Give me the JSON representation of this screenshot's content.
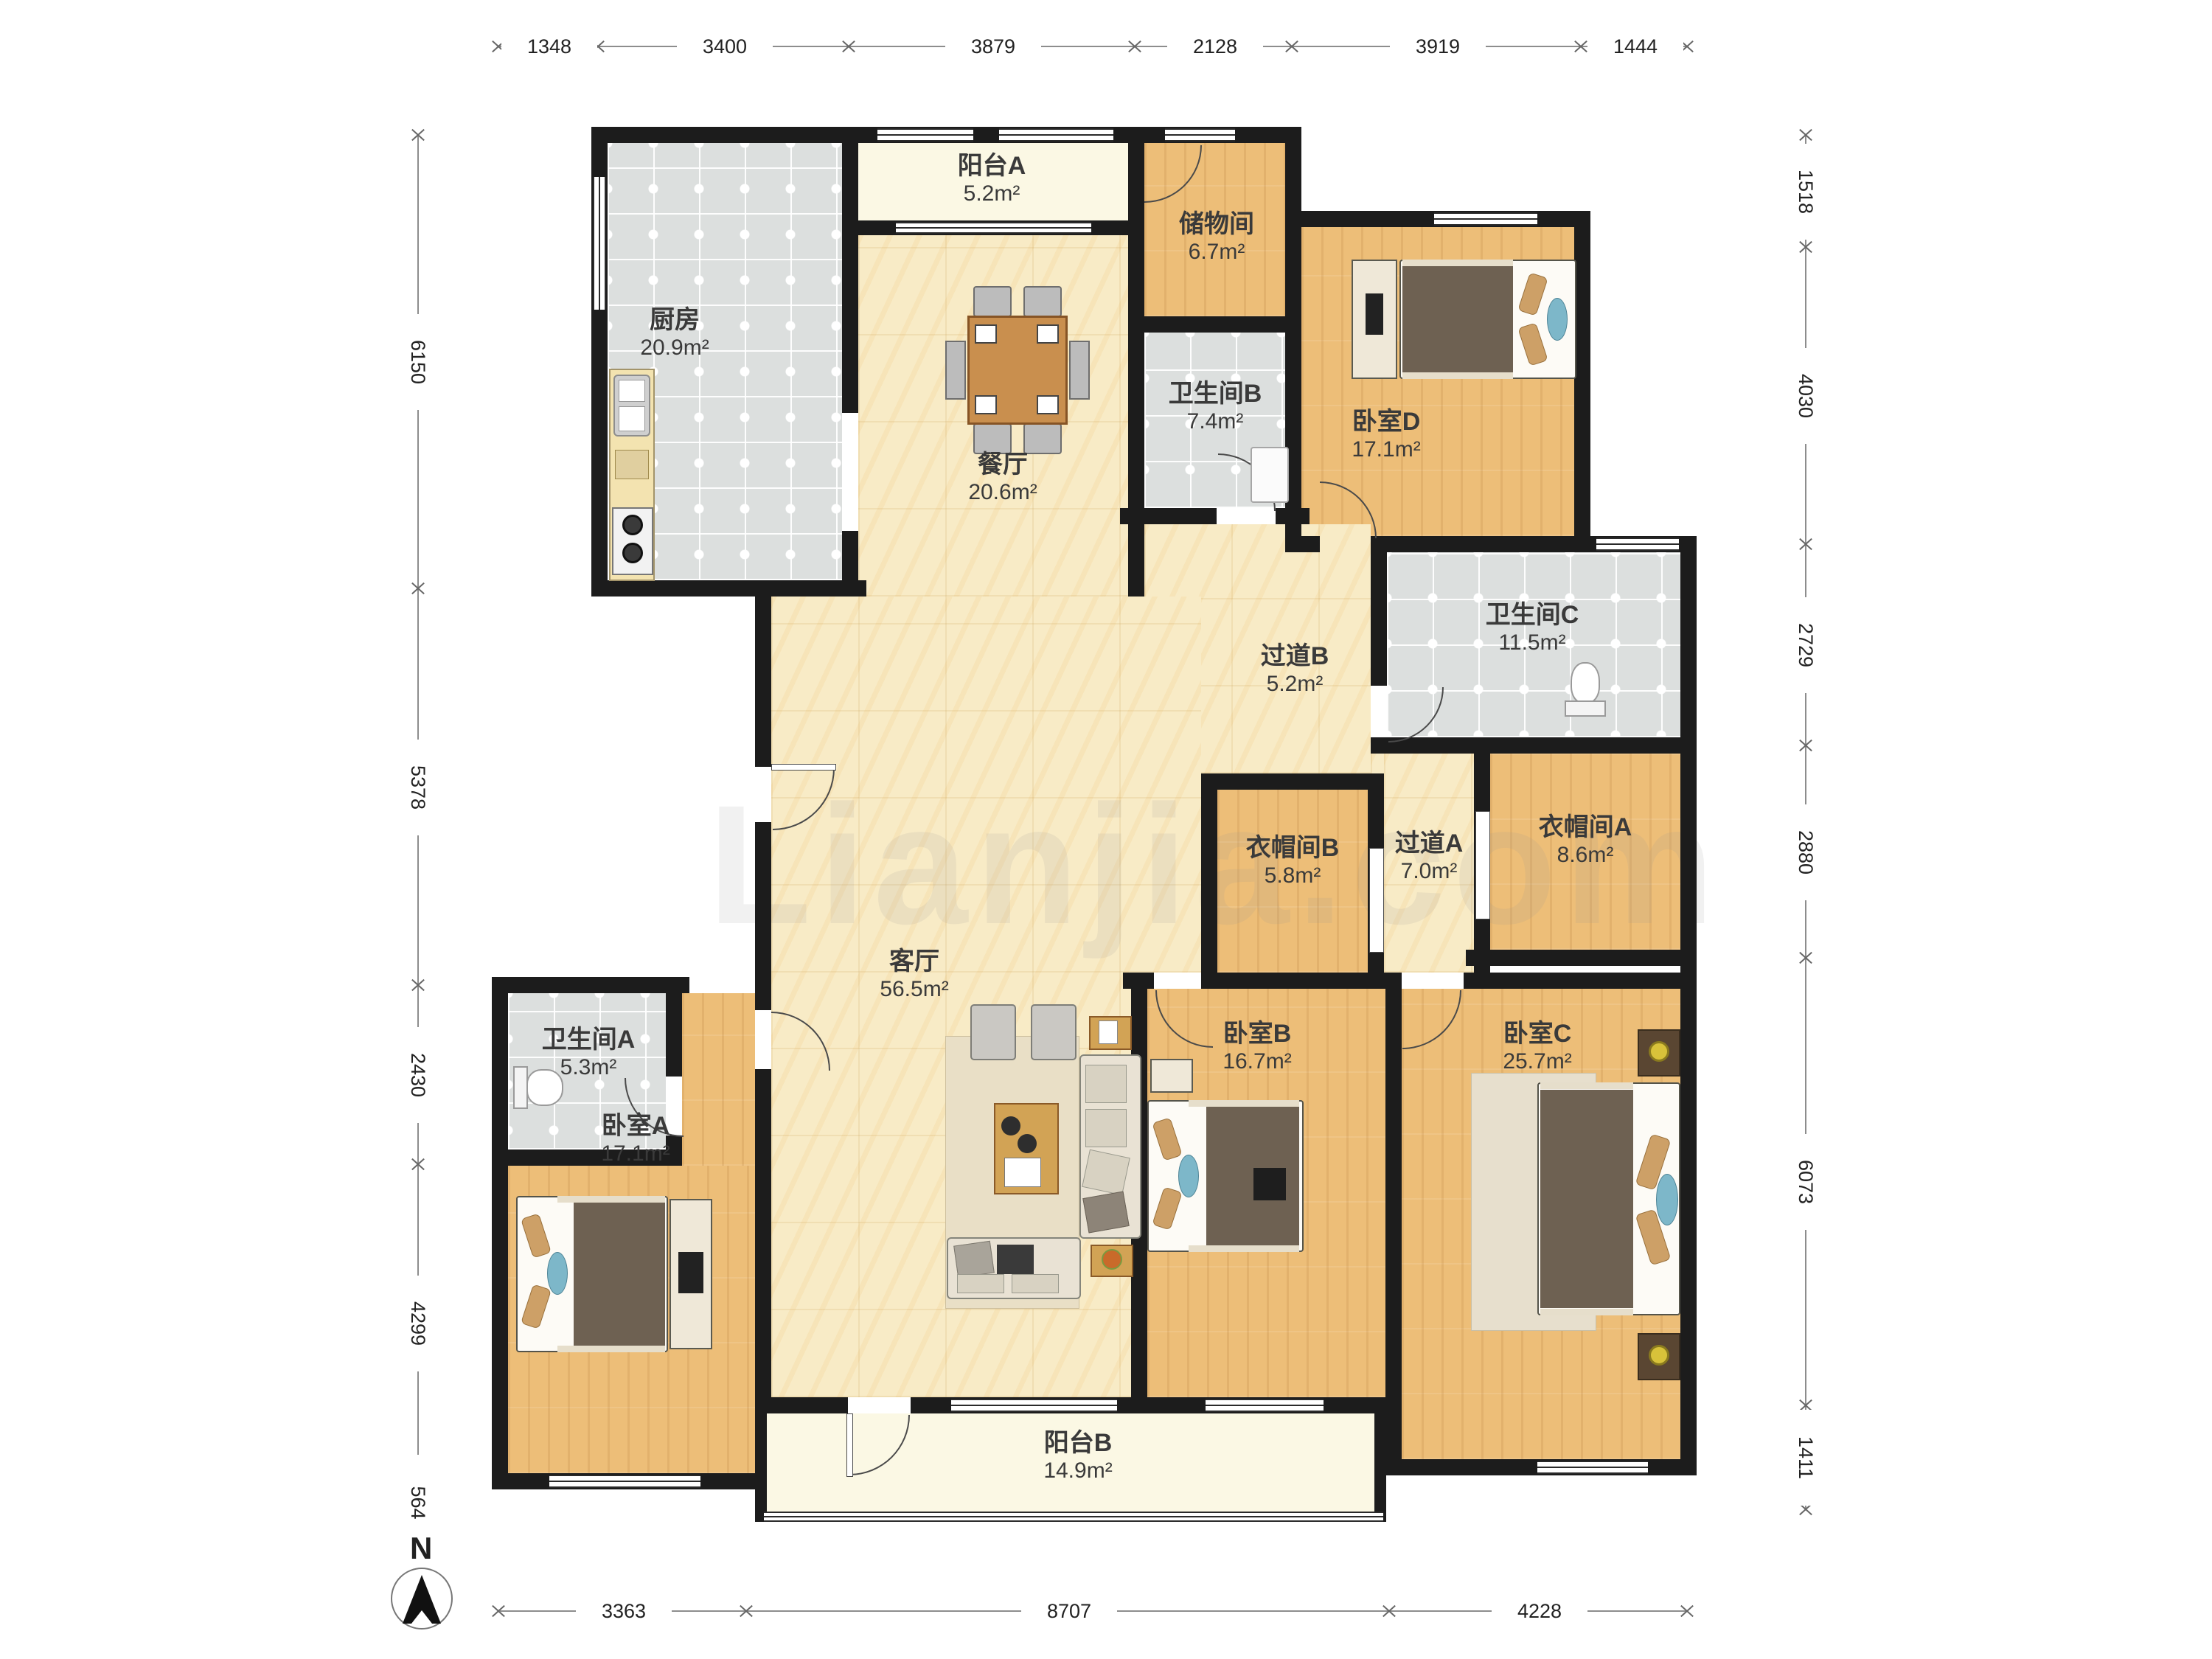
{
  "watermark": "Lianjia.com",
  "compass": {
    "label": "N"
  },
  "dims": {
    "top": [
      "1348",
      "3400",
      "3879",
      "2128",
      "3919",
      "1444"
    ],
    "left": [
      "6150",
      "5378",
      "2430",
      "4299",
      "564"
    ],
    "right": [
      "1518",
      "4030",
      "2729",
      "2880",
      "6073",
      "1411"
    ],
    "bottom": [
      "3363",
      "8707",
      "4228"
    ]
  },
  "rooms": [
    {
      "name": "厨房",
      "area": "20.9m²"
    },
    {
      "name": "阳台A",
      "area": "5.2m²"
    },
    {
      "name": "餐厅",
      "area": "20.6m²"
    },
    {
      "name": "储物间",
      "area": "6.7m²"
    },
    {
      "name": "卫生间B",
      "area": "7.4m²"
    },
    {
      "name": "卧室D",
      "area": "17.1m²"
    },
    {
      "name": "卫生间C",
      "area": "11.5m²"
    },
    {
      "name": "过道B",
      "area": "5.2m²"
    },
    {
      "name": "衣帽间B",
      "area": "5.8m²"
    },
    {
      "name": "过道A",
      "area": "7.0m²"
    },
    {
      "name": "衣帽间A",
      "area": "8.6m²"
    },
    {
      "name": "客厅",
      "area": "56.5m²"
    },
    {
      "name": "卫生间A",
      "area": "5.3m²"
    },
    {
      "name": "卧室A",
      "area": "17.1m²"
    },
    {
      "name": "卧室B",
      "area": "16.7m²"
    },
    {
      "name": "卧室C",
      "area": "25.7m²"
    },
    {
      "name": "阳台B",
      "area": "14.9m²"
    }
  ],
  "colors": {
    "wall": "#1c1c1c",
    "tile": "#dcdfde",
    "wood": "#edbe78",
    "marble": "#f8ebc6",
    "balcony": "#fbf8e4"
  }
}
